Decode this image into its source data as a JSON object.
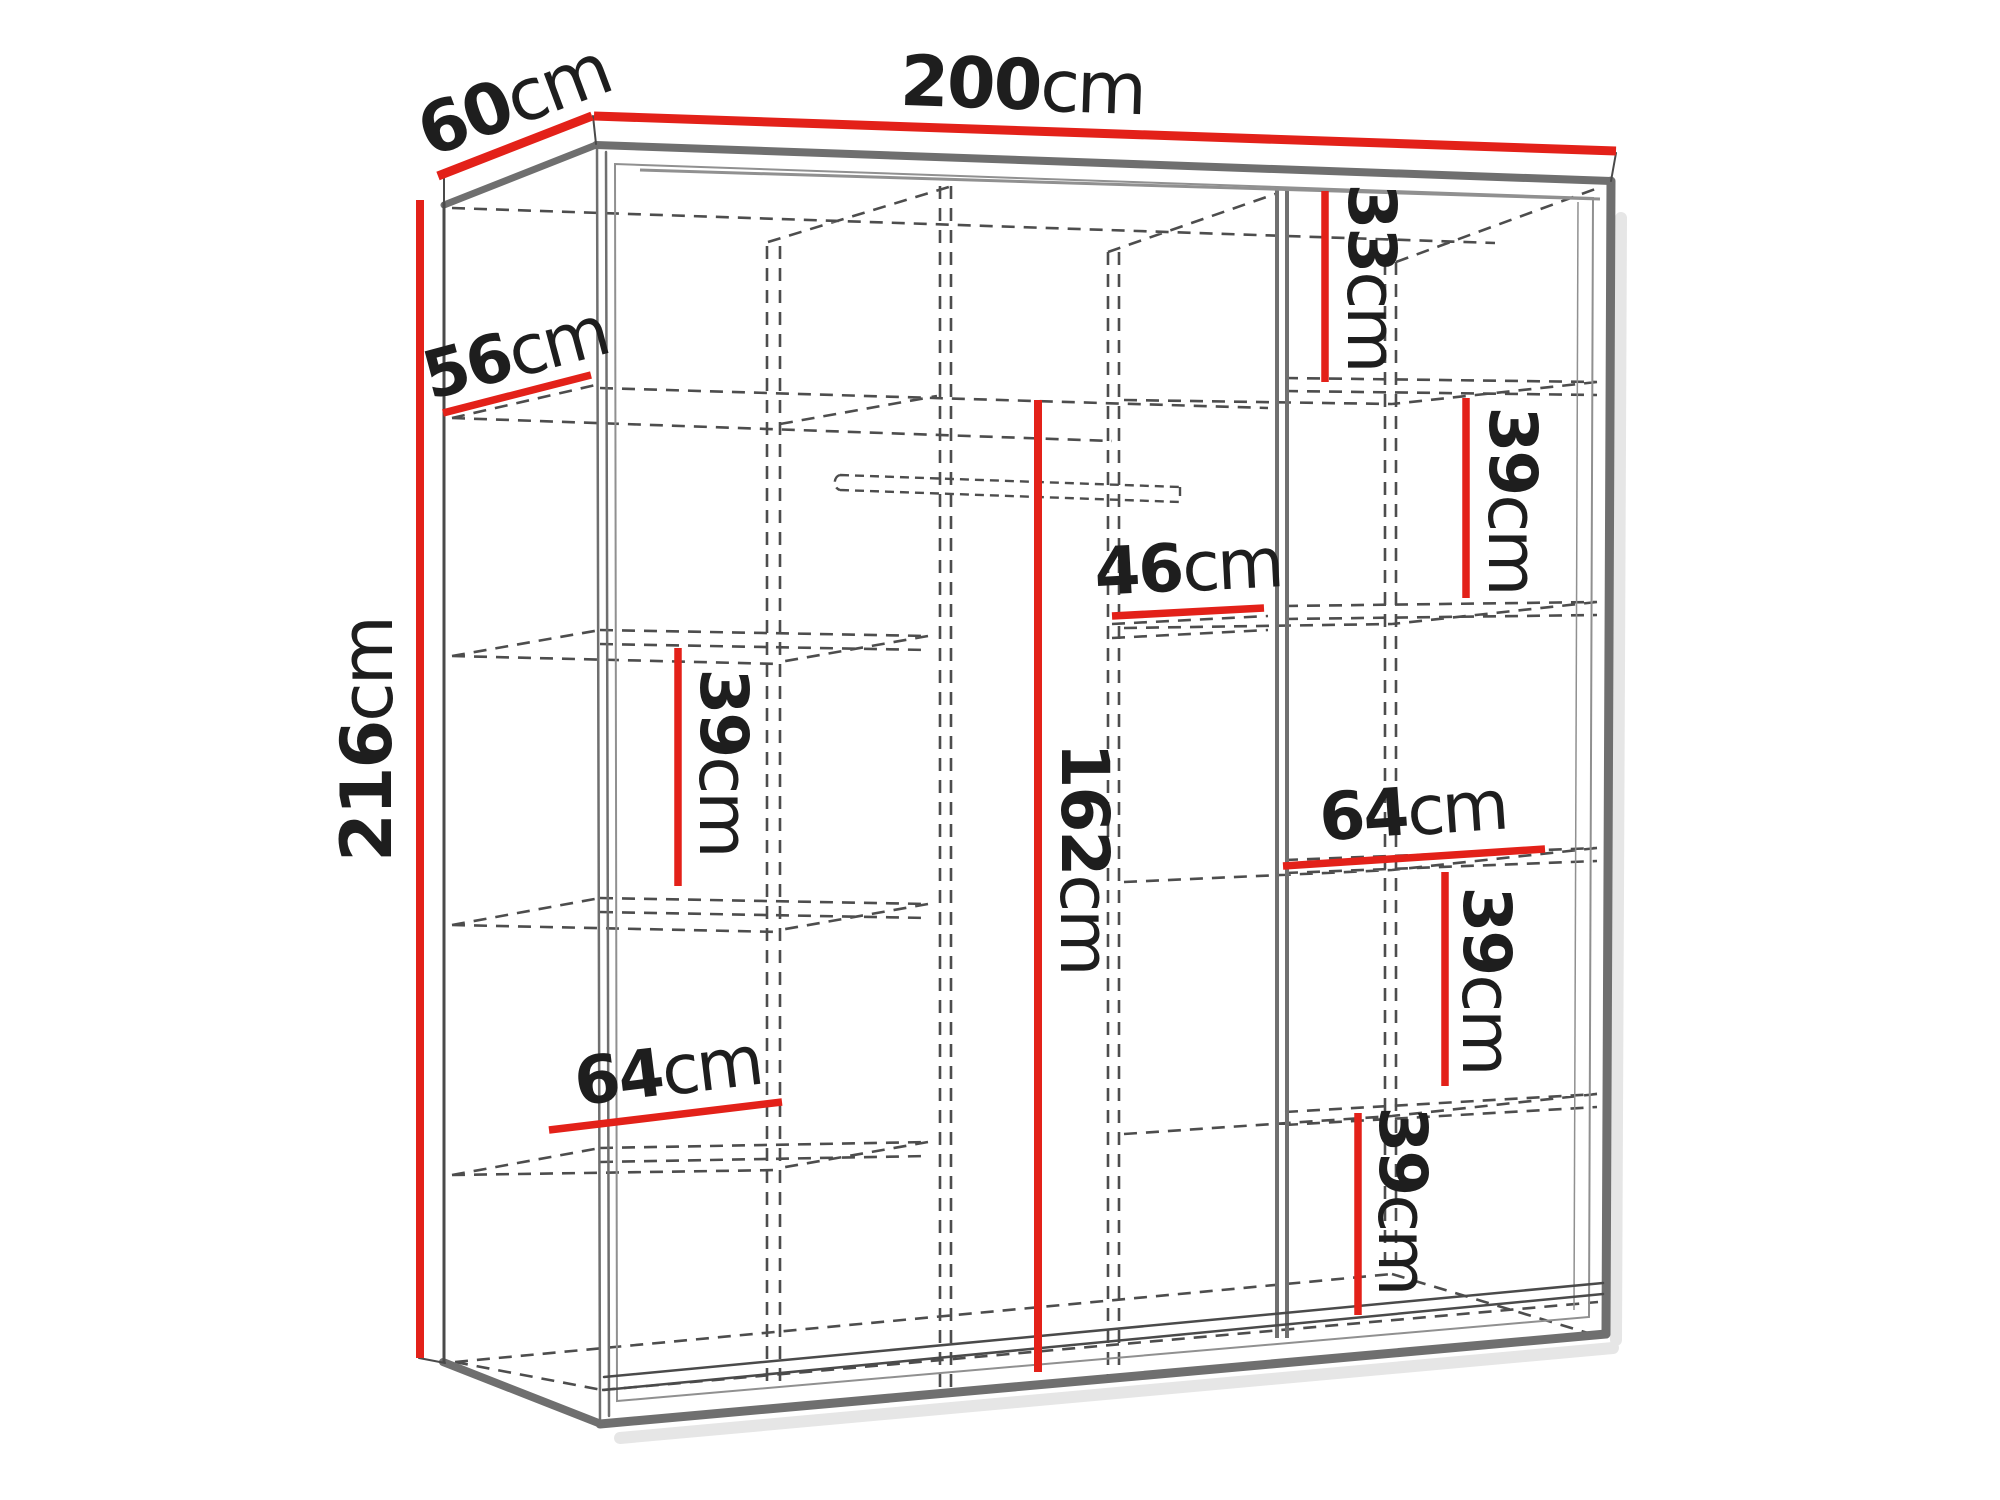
{
  "diagram": {
    "type": "wardrobe-dimension-diagram",
    "unit": "cm",
    "background": "#ffffff",
    "colors": {
      "dimension_red": "#e32119",
      "outline_gray": "#6f6f6f",
      "dark_line": "#4a4a4a",
      "dashed_gray": "#4d4d4d",
      "label_text": "#1e1e1e",
      "shadow_gray": "#e6e6e6"
    },
    "dimensions": {
      "width": {
        "value": "200",
        "unit": "cm"
      },
      "depth": {
        "value": "60",
        "unit": "cm"
      },
      "height": {
        "value": "216",
        "unit": "cm"
      },
      "shelf_depth": {
        "value": "56",
        "unit": "cm"
      },
      "right_top_gap": {
        "value": "33",
        "unit": "cm"
      },
      "right_upper_gap": {
        "value": "39",
        "unit": "cm"
      },
      "middle_back_width": {
        "value": "46",
        "unit": "cm"
      },
      "hanging_height": {
        "value": "162",
        "unit": "cm"
      },
      "left_shelf_gap": {
        "value": "39",
        "unit": "cm"
      },
      "right_shelf_width": {
        "value": "64",
        "unit": "cm"
      },
      "right_middle_gap": {
        "value": "39",
        "unit": "cm"
      },
      "left_shelf_width": {
        "value": "64",
        "unit": "cm"
      },
      "right_bottom_gap": {
        "value": "39",
        "unit": "cm"
      }
    }
  }
}
